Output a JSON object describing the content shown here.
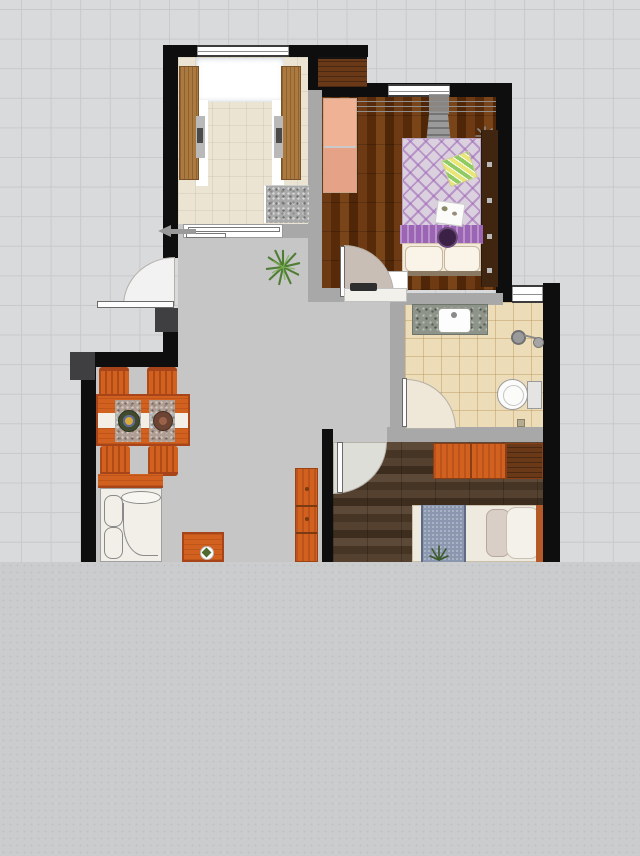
{
  "scene": {
    "type": "apartment-floor-plan",
    "canvas": {
      "width": 640,
      "height": 856,
      "plan_area_height": 562
    },
    "rooms": [
      {
        "name": "study-balcony",
        "floor": "cream-tile"
      },
      {
        "name": "master-bedroom",
        "floor": "red-wood-plank"
      },
      {
        "name": "bathroom",
        "floor": "beige-tile"
      },
      {
        "name": "second-bedroom",
        "floor": "dark-walnut-plank"
      },
      {
        "name": "living-dining-hall",
        "floor": "gray"
      }
    ],
    "furniture": [
      "desk-cabinet-left",
      "desk-cabinet-right",
      "washing-machine",
      "niche-cabinet",
      "pink-wardrobe",
      "clothes-rail",
      "master-bed",
      "bedside-shelf",
      "nightstand",
      "vanity-sink",
      "shower-head",
      "toilet",
      "dining-table",
      "dining-chairs",
      "sofa",
      "sofa-back-shelf",
      "coffee-table",
      "tv-cabinet",
      "orange-wardrobe",
      "second-bed",
      "potted-plant"
    ],
    "doors": [
      "entry-door",
      "master-bedroom-door",
      "bathroom-door",
      "second-bedroom-door"
    ],
    "windows": [
      "study-window",
      "study-sliding-window",
      "master-bedroom-window",
      "bathroom-window"
    ]
  },
  "colors": {
    "grid_bg": "#d9dadc",
    "grid_line": "#c7c9cb",
    "panel_gray": "#cbccce",
    "panel_dot": "#c0c1c3",
    "wall_black": "#0e0e0e",
    "wall_gray": "#a8a8a8",
    "wall_dark": "#3f3f41",
    "hall_floor": "#c6c6c7",
    "study_floor": "#ece4d2",
    "bedroom1_floor": "#63330f",
    "bedroom2_floor": "#4b3929",
    "bath_floor": "#eddcb8",
    "desk_wood": "#aa7a41",
    "niche_wood": "#6a3a18",
    "orange": "#d2601f",
    "orange_dark": "#a8441a",
    "orange_deep": "#6e3413",
    "wardrobe_pink": "#efb295",
    "wardrobe_pink_dark": "#e5a287",
    "quilt": "#dbd0de",
    "band_purple": "#9c64b4",
    "cushion_dark": "#3a2145",
    "pillow_cream": "#f3ead9",
    "shelf_brown": "#402511",
    "granite": "#8f948b",
    "runner_blue": "#8b97af",
    "mattress": "#efeae0",
    "sofa_white": "#f1efe8",
    "sketch": "#8a8a8a",
    "door_disc": "#f2f2f2",
    "door_disc_tan": "#c9beb5",
    "door_disc_beige": "#efe7d8",
    "door_disc_gray": "#deded9",
    "plant_green": "#4e7d33",
    "plant_green_light": "#7fb356",
    "arrow_gray": "#9a9a9a",
    "window_frame": "#3c3c3c"
  }
}
